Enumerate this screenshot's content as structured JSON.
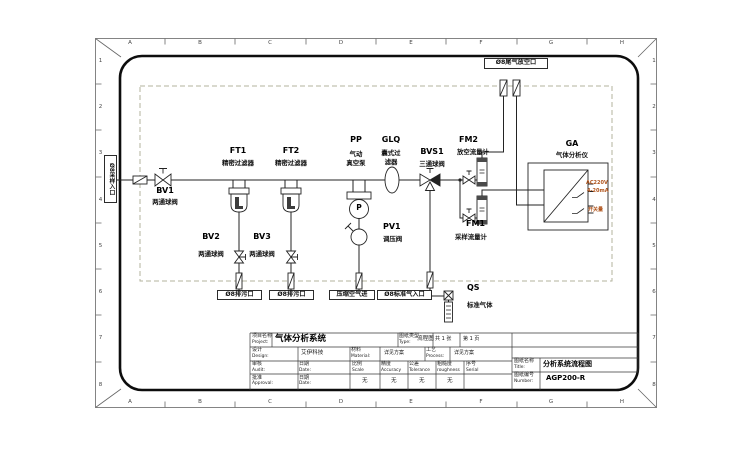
{
  "sheet": {
    "grid_cols": [
      "A",
      "B",
      "C",
      "D",
      "E",
      "F",
      "G",
      "H"
    ],
    "grid_rows": [
      "1",
      "2",
      "3",
      "4",
      "5",
      "6",
      "7",
      "8"
    ]
  },
  "ports": {
    "sample_inlet": "Ø8采样入口",
    "tail_gas_vent": "Ø8尾气放空口",
    "drain_left": "Ø8排污口",
    "drain_right": "Ø8排污口",
    "compressed_air_in": "压缩空气进",
    "standard_gas_inlet": "Ø8标准气入口"
  },
  "components": {
    "bv1": {
      "tag": "BV1",
      "name": "两通球阀"
    },
    "bv2": {
      "tag": "BV2",
      "name": "两通球阀"
    },
    "bv3": {
      "tag": "BV3",
      "name": "两通球阀"
    },
    "ft1": {
      "tag": "FT1",
      "name": "精密过滤器"
    },
    "ft2": {
      "tag": "FT2",
      "name": "精密过滤器"
    },
    "pp": {
      "tag": "PP",
      "name1": "气动",
      "name2": "真空泵",
      "pump_letter": "P"
    },
    "glq": {
      "tag": "GLQ",
      "name1": "囊式过",
      "name2": "滤器"
    },
    "pv1": {
      "tag": "PV1",
      "name": "调压阀"
    },
    "bvs1": {
      "tag": "BVS1",
      "name": "三通球阀"
    },
    "fm1": {
      "tag": "FM1",
      "name": "采样流量计"
    },
    "fm2": {
      "tag": "FM2",
      "name": "放空流量计"
    },
    "ga": {
      "tag": "GA",
      "name": "气体分析仪",
      "signal_power": "AC220V",
      "signal_analog": "4-20mA",
      "signal_switch": "开关量"
    },
    "qs": {
      "tag": "QS",
      "name": "标准气体"
    }
  },
  "title_block": {
    "project_label_cn": "项目名称",
    "project_label_en": "Project:",
    "project_value": "气体分析系统",
    "type_label_cn": "图纸类型",
    "type_label_en": "Type:",
    "type_value": "流程图",
    "sheets_total": "共 1 张",
    "sheet_page": "第 1 页",
    "design_label_cn": "设计",
    "design_label_en": "Design:",
    "design_value": "艾伊科技",
    "material_label_cn": "材料",
    "material_label_en": "Material:",
    "material_value": "详见方案",
    "process_label_cn": "工艺",
    "process_label_en": "Process:",
    "process_value": "详见方案",
    "audit_label_cn": "审核",
    "audit_label_en": "Audit:",
    "approval_label_cn": "批准",
    "approval_label_en": "Approval:",
    "date1_label_cn": "日期",
    "date1_label_en": "Date:",
    "date2_label_cn": "日期",
    "date2_label_en": "Date:",
    "scale_label_cn": "比例",
    "scale_label_en": "Scale",
    "accuracy_label_cn": "精度",
    "accuracy_label_en": "Accuracy",
    "tolerance_label_cn": "公差",
    "tolerance_label_en": "Tolerance",
    "roughness_label_cn": "粗糙度",
    "roughness_label_en": "roughness",
    "serial_label_cn": "序号",
    "serial_label_en": "Serial",
    "scale_value": "无",
    "accuracy_value": "无",
    "tolerance_value": "无",
    "roughness_value": "无",
    "title_label_cn": "图纸名称",
    "title_label_en": "Title:",
    "title_value": "分析系统流程图",
    "number_label_cn": "图纸编号",
    "number_label_en": "Number:",
    "number_value": "AGP200-R"
  },
  "colors": {
    "line": "#222222",
    "dashed_boundary": "#b3b39e",
    "signal_text": "#b0541c"
  }
}
